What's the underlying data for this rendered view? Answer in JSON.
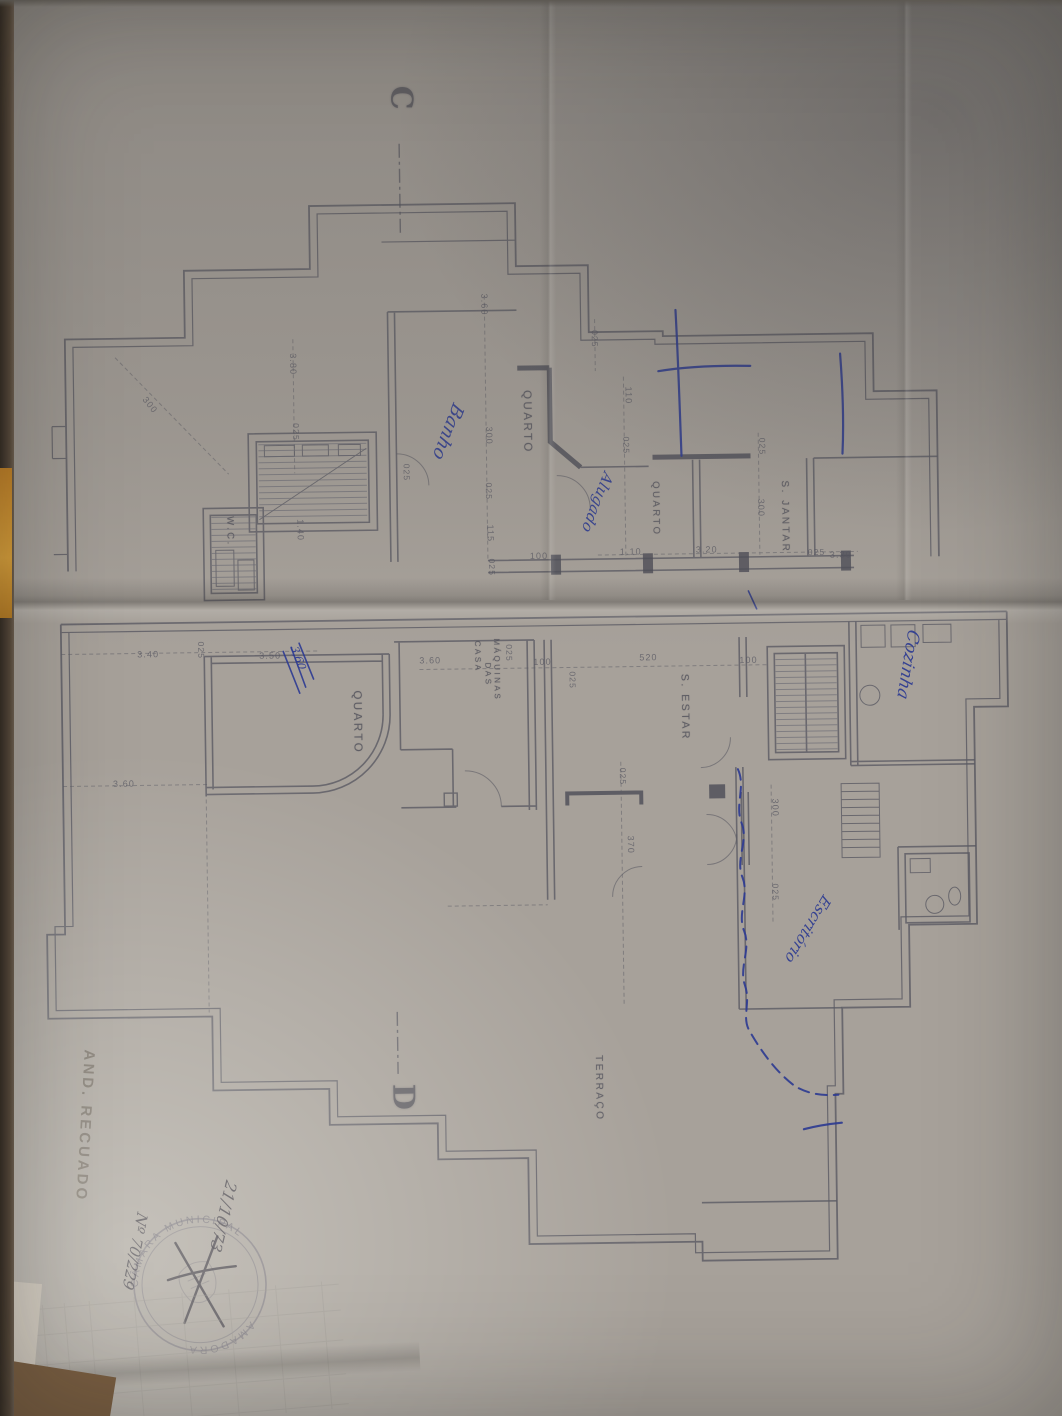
{
  "stamp": {
    "ring_top": "CÂMARA MUNICIPAL",
    "ring_bottom": "AMADORA"
  },
  "colors": {
    "paper": "#a7a19a",
    "plan_line": "#5b5b64",
    "ink_blue": "#2c3a92",
    "pencil": "#6f675e",
    "desk": "#7b5f42",
    "orange_edge": "#d9a03a"
  },
  "labels": [
    {
      "text": "C",
      "x": 424,
      "y": 84,
      "rot": 90,
      "size": 30,
      "cls": "marker",
      "name": "section-marker-c"
    },
    {
      "text": "D",
      "x": 412,
      "y": 1082,
      "rot": 90,
      "size": 30,
      "cls": "marker",
      "name": "section-marker-d"
    },
    {
      "text": "QUARTO",
      "x": 536,
      "y": 390,
      "rot": 90,
      "size": 11.5,
      "cls": "room",
      "name": "room-label-quarto-1"
    },
    {
      "text": "QUARTO",
      "x": 663,
      "y": 483,
      "rot": 90,
      "size": 9.5,
      "cls": "room",
      "name": "room-label-quarto-2"
    },
    {
      "text": "QUARTO",
      "x": 362,
      "y": 688,
      "rot": 90,
      "size": 11.5,
      "cls": "room",
      "name": "room-label-quarto-3"
    },
    {
      "text": "W.C.",
      "x": 237,
      "y": 512,
      "rot": 90,
      "size": 9.5,
      "cls": "room",
      "name": "room-label-wc"
    },
    {
      "text": "S. JANTAR",
      "x": 792,
      "y": 484,
      "rot": 90,
      "size": 10,
      "cls": "room",
      "name": "room-label-s-jantar"
    },
    {
      "text": "S. ESTAR",
      "x": 690,
      "y": 676,
      "rot": 90,
      "size": 10.5,
      "cls": "room",
      "name": "room-label-s-estar"
    },
    {
      "text": "CASA",
      "x": 482,
      "y": 640,
      "rot": 90,
      "size": 8,
      "cls": "room",
      "name": "room-label-casa"
    },
    {
      "text": "DAS",
      "x": 492,
      "y": 662,
      "rot": 90,
      "size": 8,
      "cls": "room",
      "name": "room-label-das"
    },
    {
      "text": "MÁQUINAS",
      "x": 501,
      "y": 638,
      "rot": 90,
      "size": 8,
      "cls": "room",
      "name": "room-label-maquinas"
    },
    {
      "text": "TERRAÇO",
      "x": 598,
      "y": 1056,
      "rot": 90,
      "size": 10,
      "cls": "room",
      "name": "room-label-terraco"
    },
    {
      "text": "3.80",
      "x": 302,
      "y": 350,
      "rot": 90,
      "size": 9,
      "cls": "dim",
      "name": "dimension-label"
    },
    {
      "text": "3.60",
      "x": 494,
      "y": 293,
      "rot": 90,
      "size": 9,
      "cls": "dim",
      "name": "dimension-label"
    },
    {
      "text": "300",
      "x": 152,
      "y": 390,
      "rot": 52,
      "size": 9,
      "cls": "dim",
      "name": "dimension-label"
    },
    {
      "text": "025",
      "x": 304,
      "y": 420,
      "rot": 90,
      "size": 8.5,
      "cls": "dim",
      "name": "dimension-label"
    },
    {
      "text": "300",
      "x": 497,
      "y": 426,
      "rot": 90,
      "size": 9,
      "cls": "dim",
      "name": "dimension-label"
    },
    {
      "text": "025",
      "x": 496,
      "y": 482,
      "rot": 90,
      "size": 8.5,
      "cls": "dim",
      "name": "dimension-label"
    },
    {
      "text": "115",
      "x": 497,
      "y": 524,
      "rot": 90,
      "size": 9,
      "cls": "dim",
      "name": "dimension-label"
    },
    {
      "text": "025",
      "x": 498,
      "y": 558,
      "rot": 90,
      "size": 8.5,
      "cls": "dim",
      "name": "dimension-label"
    },
    {
      "text": "100",
      "x": 532,
      "y": 552,
      "rot": 0,
      "size": 9,
      "cls": "dim",
      "name": "dimension-label"
    },
    {
      "text": "1.40",
      "x": 307,
      "y": 516,
      "rot": 90,
      "size": 9,
      "cls": "dim",
      "name": "dimension-label"
    },
    {
      "text": "025",
      "x": 414,
      "y": 462,
      "rot": 90,
      "size": 8.5,
      "cls": "dim",
      "name": "dimension-label"
    },
    {
      "text": "110",
      "x": 637,
      "y": 388,
      "rot": 90,
      "size": 9,
      "cls": "dim",
      "name": "dimension-label"
    },
    {
      "text": "025",
      "x": 634,
      "y": 438,
      "rot": 90,
      "size": 8.5,
      "cls": "dim",
      "name": "dimension-label"
    },
    {
      "text": "025",
      "x": 604,
      "y": 331,
      "rot": 90,
      "size": 8.5,
      "cls": "dim",
      "name": "dimension-label"
    },
    {
      "text": "1.10",
      "x": 622,
      "y": 549,
      "rot": 0,
      "size": 9,
      "cls": "dim",
      "name": "dimension-label"
    },
    {
      "text": "3.20",
      "x": 698,
      "y": 548,
      "rot": 0,
      "size": 9,
      "cls": "dim",
      "name": "dimension-label"
    },
    {
      "text": "025",
      "x": 810,
      "y": 552,
      "rot": 0,
      "size": 8.5,
      "cls": "dim",
      "name": "dimension-label"
    },
    {
      "text": "3.30",
      "x": 832,
      "y": 555,
      "rot": 0,
      "size": 9,
      "cls": "dim",
      "name": "dimension-label"
    },
    {
      "text": "300",
      "x": 768,
      "y": 502,
      "rot": 90,
      "size": 9,
      "cls": "dim",
      "name": "dimension-label"
    },
    {
      "text": "025",
      "x": 770,
      "y": 441,
      "rot": 90,
      "size": 8.5,
      "cls": "dim",
      "name": "dimension-label"
    },
    {
      "text": "3.40",
      "x": 138,
      "y": 645,
      "rot": 0,
      "size": 9,
      "cls": "dim",
      "name": "dimension-label"
    },
    {
      "text": "025",
      "x": 206,
      "y": 637,
      "rot": 90,
      "size": 8.5,
      "cls": "dim",
      "name": "dimension-label"
    },
    {
      "text": "3.50",
      "x": 260,
      "y": 648,
      "rot": 0,
      "size": 9,
      "cls": "dim",
      "name": "dimension-label"
    },
    {
      "text": "3.60",
      "x": 112,
      "y": 774,
      "rot": 0,
      "size": 9,
      "cls": "dim",
      "name": "dimension-label"
    },
    {
      "text": "3.60",
      "x": 420,
      "y": 655,
      "rot": 0,
      "size": 9,
      "cls": "dim",
      "name": "dimension-label"
    },
    {
      "text": "025",
      "x": 514,
      "y": 644,
      "rot": 90,
      "size": 8.5,
      "cls": "dim",
      "name": "dimension-label"
    },
    {
      "text": "100",
      "x": 534,
      "y": 658,
      "rot": 0,
      "size": 9,
      "cls": "dim",
      "name": "dimension-label"
    },
    {
      "text": "025",
      "x": 577,
      "y": 672,
      "rot": 90,
      "size": 8.5,
      "cls": "dim",
      "name": "dimension-label"
    },
    {
      "text": "520",
      "x": 640,
      "y": 655,
      "rot": 0,
      "size": 9,
      "cls": "dim",
      "name": "dimension-label"
    },
    {
      "text": "100",
      "x": 740,
      "y": 659,
      "rot": 0,
      "size": 9,
      "cls": "dim",
      "name": "dimension-label"
    },
    {
      "text": "025",
      "x": 626,
      "y": 769,
      "rot": 90,
      "size": 8.5,
      "cls": "dim",
      "name": "dimension-label"
    },
    {
      "text": "370",
      "x": 633,
      "y": 837,
      "rot": 90,
      "size": 9,
      "cls": "dim",
      "name": "dimension-label"
    },
    {
      "text": "300",
      "x": 778,
      "y": 802,
      "rot": 90,
      "size": 9,
      "cls": "dim",
      "name": "dimension-label"
    },
    {
      "text": "025",
      "x": 777,
      "y": 887,
      "rot": 90,
      "size": 8.5,
      "cls": "dim",
      "name": "dimension-label"
    },
    {
      "text": "Banho",
      "x": 470,
      "y": 408,
      "rot": 112,
      "size": 18,
      "cls": "ink",
      "name": "note-banho"
    },
    {
      "text": "Alugado",
      "x": 618,
      "y": 478,
      "rot": 112,
      "size": 15,
      "cls": "ink",
      "name": "note-alugado"
    },
    {
      "text": "Cozinha",
      "x": 922,
      "y": 638,
      "rot": 100,
      "size": 17,
      "cls": "ink",
      "name": "note-cozinha"
    },
    {
      "text": "Escritório",
      "x": 830,
      "y": 906,
      "rot": 122,
      "size": 15,
      "cls": "ink",
      "name": "note-escritorio"
    },
    {
      "text": "3,60",
      "x": 300,
      "y": 642,
      "rot": 70,
      "size": 11,
      "cls": "ink",
      "name": "note-correction-360"
    },
    {
      "text": "AND. RECUADO",
      "x": 92,
      "y": 1044,
      "rot": 94,
      "size": 15,
      "cls": "pencil",
      "name": "note-and-recuado"
    },
    {
      "text": "21/10/73",
      "x": 232,
      "y": 1180,
      "rot": 104,
      "size": 16,
      "cls": "stampink",
      "name": "stamp-note-date"
    },
    {
      "text": "Nº 70/229",
      "x": 142,
      "y": 1210,
      "rot": 102,
      "size": 15,
      "cls": "stampink",
      "name": "stamp-note-number"
    }
  ]
}
